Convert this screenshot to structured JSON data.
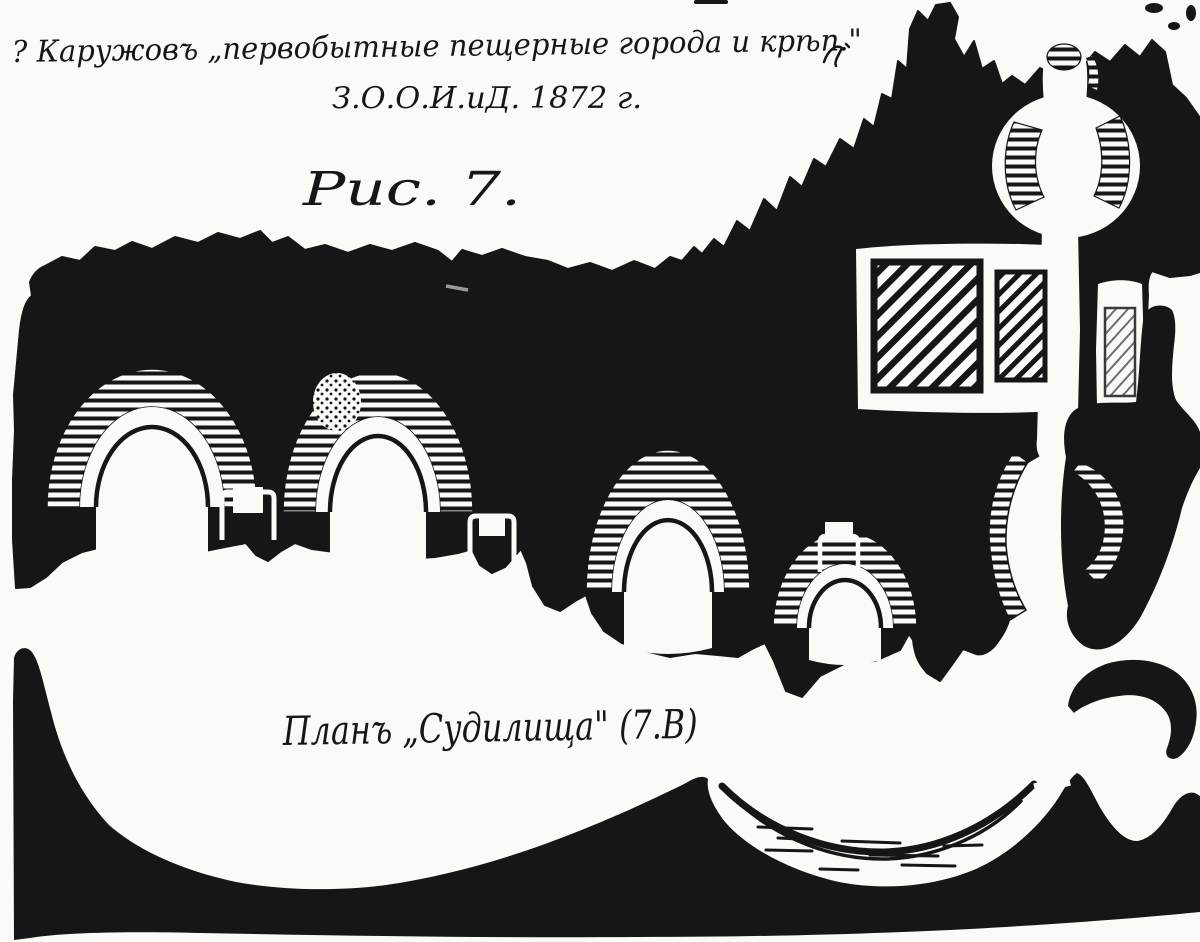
{
  "document": {
    "type_label": "scanned handwritten figure page",
    "annotations": {
      "citation_line1": "? Каружовъ „первобытные пещерные города и крѣп.\"",
      "citation_line2": "З.О.О.И.иД.  1872 г.",
      "figure_label": "Рис. 7.",
      "caption": "Планъ „Судилища\" (7.В)",
      "corner_mark": "c"
    },
    "colors": {
      "ink": "#161616",
      "paper": "#fbfaf7",
      "faint_mark": "#9a9a9a",
      "light_hatch": "#6e6e6e"
    }
  }
}
